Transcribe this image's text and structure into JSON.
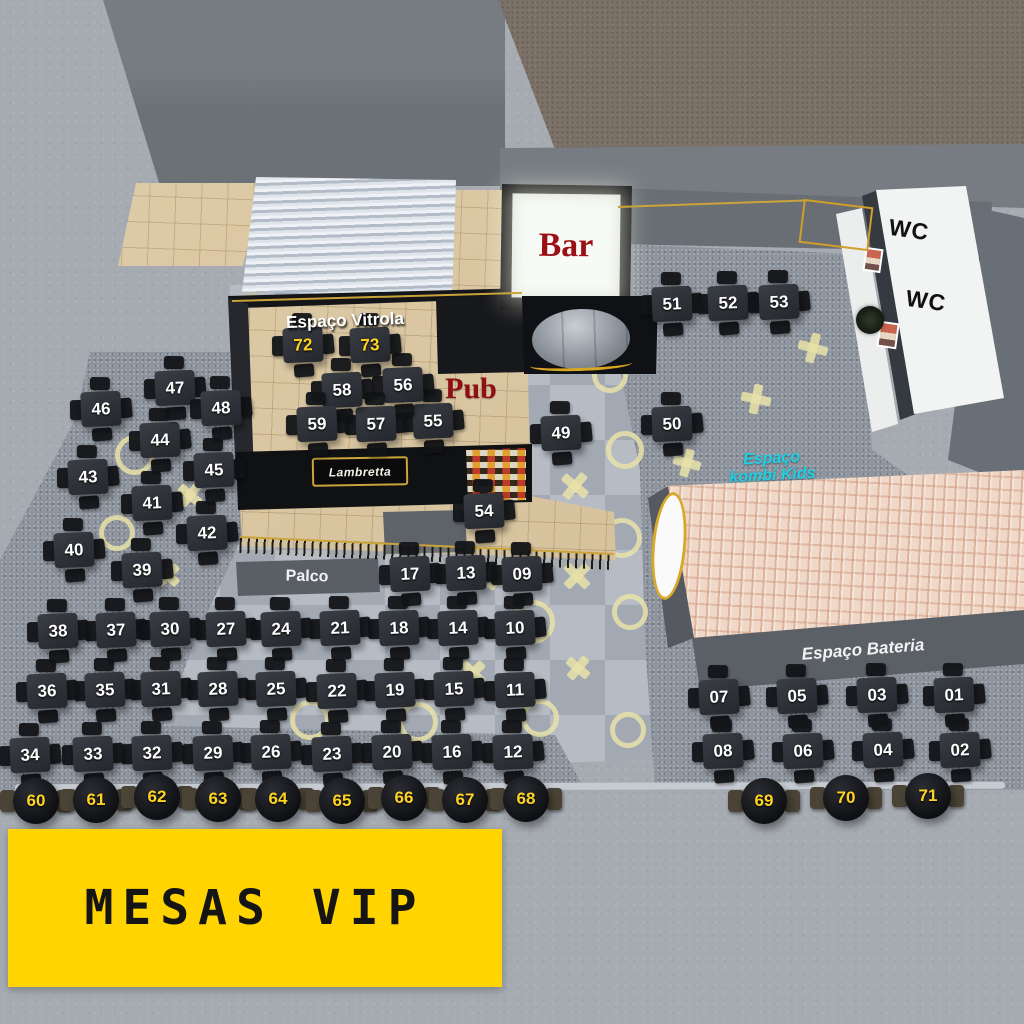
{
  "signs": {
    "bar": "Bar",
    "pub": "Pub",
    "vitrola": "Espaço Vitrola",
    "wc_top": "WC",
    "wc_bottom": "WC",
    "kombi_l1": "Espaço",
    "kombi_l2": "kombi Kids",
    "palco": "Palco",
    "bateria": "Espaço Bateria",
    "pub_marquee": "Lambretta",
    "vip_banner": "MESAS VIP"
  },
  "colors": {
    "vip_number": "#ffd324",
    "table_number": "#ffffff",
    "banner_bg": "#ffd400",
    "banner_text": "#151515",
    "bar_text": "#9b1016",
    "pub_text": "#8e1014",
    "kombi_text": "#1ed0e6",
    "bateria_text": "#f2f2f2",
    "floor_mark": "#e9e2a8",
    "roof_tile": "#f0d8c9"
  },
  "tables": {
    "square": [
      {
        "n": "01",
        "x": 954,
        "y": 695
      },
      {
        "n": "02",
        "x": 960,
        "y": 750
      },
      {
        "n": "03",
        "x": 877,
        "y": 695
      },
      {
        "n": "04",
        "x": 883,
        "y": 750
      },
      {
        "n": "05",
        "x": 797,
        "y": 696
      },
      {
        "n": "06",
        "x": 803,
        "y": 751
      },
      {
        "n": "07",
        "x": 719,
        "y": 697
      },
      {
        "n": "08",
        "x": 723,
        "y": 751
      },
      {
        "n": "09",
        "x": 522,
        "y": 574
      },
      {
        "n": "10",
        "x": 515,
        "y": 628
      },
      {
        "n": "11",
        "x": 515,
        "y": 690
      },
      {
        "n": "12",
        "x": 513,
        "y": 752
      },
      {
        "n": "13",
        "x": 466,
        "y": 573
      },
      {
        "n": "14",
        "x": 458,
        "y": 628
      },
      {
        "n": "15",
        "x": 454,
        "y": 689
      },
      {
        "n": "16",
        "x": 452,
        "y": 752
      },
      {
        "n": "17",
        "x": 410,
        "y": 574
      },
      {
        "n": "18",
        "x": 399,
        "y": 628
      },
      {
        "n": "19",
        "x": 395,
        "y": 690
      },
      {
        "n": "20",
        "x": 392,
        "y": 752
      },
      {
        "n": "21",
        "x": 340,
        "y": 628
      },
      {
        "n": "22",
        "x": 337,
        "y": 691
      },
      {
        "n": "23",
        "x": 332,
        "y": 754
      },
      {
        "n": "24",
        "x": 281,
        "y": 629
      },
      {
        "n": "25",
        "x": 276,
        "y": 689
      },
      {
        "n": "26",
        "x": 271,
        "y": 752
      },
      {
        "n": "27",
        "x": 226,
        "y": 629
      },
      {
        "n": "28",
        "x": 218,
        "y": 689
      },
      {
        "n": "29",
        "x": 213,
        "y": 753
      },
      {
        "n": "30",
        "x": 170,
        "y": 629
      },
      {
        "n": "31",
        "x": 161,
        "y": 689
      },
      {
        "n": "32",
        "x": 152,
        "y": 753
      },
      {
        "n": "33",
        "x": 93,
        "y": 754
      },
      {
        "n": "34",
        "x": 30,
        "y": 755
      },
      {
        "n": "35",
        "x": 105,
        "y": 690
      },
      {
        "n": "36",
        "x": 47,
        "y": 691
      },
      {
        "n": "37",
        "x": 116,
        "y": 630
      },
      {
        "n": "38",
        "x": 58,
        "y": 631
      },
      {
        "n": "39",
        "x": 142,
        "y": 570
      },
      {
        "n": "40",
        "x": 74,
        "y": 550
      },
      {
        "n": "41",
        "x": 152,
        "y": 503
      },
      {
        "n": "42",
        "x": 207,
        "y": 533
      },
      {
        "n": "43",
        "x": 88,
        "y": 477
      },
      {
        "n": "44",
        "x": 160,
        "y": 440
      },
      {
        "n": "45",
        "x": 214,
        "y": 470
      },
      {
        "n": "46",
        "x": 101,
        "y": 409
      },
      {
        "n": "47",
        "x": 175,
        "y": 388
      },
      {
        "n": "48",
        "x": 221,
        "y": 408
      },
      {
        "n": "49",
        "x": 561,
        "y": 433
      },
      {
        "n": "50",
        "x": 672,
        "y": 424
      },
      {
        "n": "51",
        "x": 672,
        "y": 304
      },
      {
        "n": "52",
        "x": 728,
        "y": 303
      },
      {
        "n": "53",
        "x": 779,
        "y": 302
      },
      {
        "n": "54",
        "x": 484,
        "y": 511
      },
      {
        "n": "55",
        "x": 433,
        "y": 421
      },
      {
        "n": "56",
        "x": 403,
        "y": 385
      },
      {
        "n": "57",
        "x": 376,
        "y": 424
      },
      {
        "n": "58",
        "x": 342,
        "y": 390
      },
      {
        "n": "59",
        "x": 317,
        "y": 424
      },
      {
        "n": "72",
        "x": 303,
        "y": 345,
        "yellow": true
      },
      {
        "n": "73",
        "x": 370,
        "y": 345,
        "yellow": true
      }
    ],
    "round_vip": [
      {
        "n": "60",
        "x": 36,
        "y": 801
      },
      {
        "n": "61",
        "x": 96,
        "y": 800
      },
      {
        "n": "62",
        "x": 157,
        "y": 797
      },
      {
        "n": "63",
        "x": 218,
        "y": 799
      },
      {
        "n": "64",
        "x": 278,
        "y": 799
      },
      {
        "n": "65",
        "x": 342,
        "y": 801
      },
      {
        "n": "66",
        "x": 404,
        "y": 798
      },
      {
        "n": "67",
        "x": 465,
        "y": 800
      },
      {
        "n": "68",
        "x": 526,
        "y": 799
      },
      {
        "n": "69",
        "x": 764,
        "y": 801
      },
      {
        "n": "70",
        "x": 846,
        "y": 798
      },
      {
        "n": "71",
        "x": 928,
        "y": 796
      }
    ]
  },
  "decor": {
    "marks": [
      {
        "t": "o",
        "x": 135,
        "y": 455,
        "s": 30
      },
      {
        "t": "o",
        "x": 117,
        "y": 533,
        "s": 26
      },
      {
        "t": "o",
        "x": 308,
        "y": 522,
        "s": 26
      },
      {
        "t": "o",
        "x": 533,
        "y": 622,
        "s": 34
      },
      {
        "t": "o",
        "x": 310,
        "y": 720,
        "s": 30
      },
      {
        "t": "o",
        "x": 418,
        "y": 722,
        "s": 30
      },
      {
        "t": "o",
        "x": 540,
        "y": 718,
        "s": 28
      },
      {
        "t": "o",
        "x": 625,
        "y": 450,
        "s": 28
      },
      {
        "t": "o",
        "x": 622,
        "y": 538,
        "s": 30
      },
      {
        "t": "o",
        "x": 610,
        "y": 375,
        "s": 26
      },
      {
        "t": "o",
        "x": 630,
        "y": 612,
        "s": 26
      },
      {
        "t": "o",
        "x": 628,
        "y": 730,
        "s": 26
      },
      {
        "t": "x",
        "x": 190,
        "y": 495,
        "r": 40,
        "s": 26
      },
      {
        "t": "x",
        "x": 168,
        "y": 575,
        "r": 45,
        "s": 26
      },
      {
        "t": "x",
        "x": 575,
        "y": 486,
        "r": 40,
        "s": 30
      },
      {
        "t": "x",
        "x": 577,
        "y": 576,
        "r": 45,
        "s": 30
      },
      {
        "t": "x",
        "x": 497,
        "y": 578,
        "r": 35,
        "s": 26
      },
      {
        "t": "x",
        "x": 473,
        "y": 673,
        "r": 45,
        "s": 28
      },
      {
        "t": "x",
        "x": 578,
        "y": 668,
        "r": 40,
        "s": 26
      },
      {
        "t": "x",
        "x": 813,
        "y": 348,
        "r": 15,
        "s": 30
      },
      {
        "t": "x",
        "x": 756,
        "y": 399,
        "r": 12,
        "s": 30
      },
      {
        "t": "x",
        "x": 687,
        "y": 463,
        "r": 15,
        "s": 28
      }
    ],
    "bulbs": [
      {
        "x": 252,
        "y": 303
      },
      {
        "x": 352,
        "y": 298
      },
      {
        "x": 433,
        "y": 297
      },
      {
        "x": 250,
        "y": 434
      },
      {
        "x": 333,
        "y": 441
      },
      {
        "x": 432,
        "y": 447
      },
      {
        "x": 703,
        "y": 200
      },
      {
        "x": 790,
        "y": 200
      },
      {
        "x": 1020,
        "y": 455
      },
      {
        "x": 527,
        "y": 317
      }
    ]
  }
}
